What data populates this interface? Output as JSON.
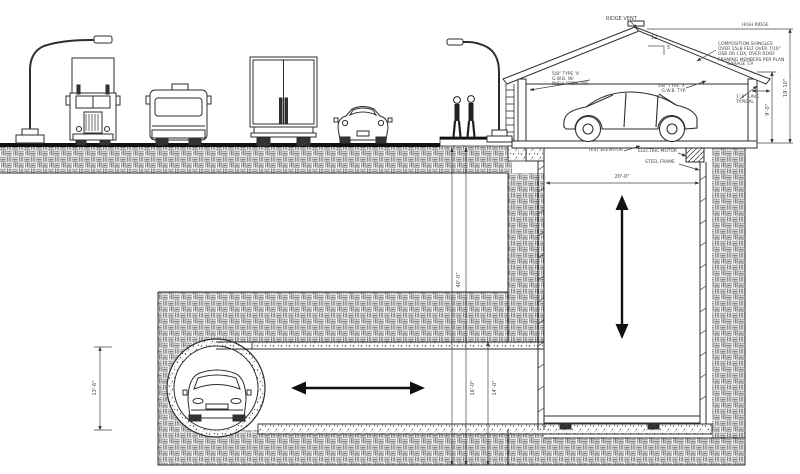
{
  "colors": {
    "line": "#2e2e2e",
    "road": "#111111",
    "background": "#ffffff",
    "hatch": "#777777"
  },
  "labels": {
    "ridge_vent": "RIDGE VENT",
    "high_ridge": "HIGH RIDGE",
    "roof_note": "COMPOSITION SHINGLES\nOVER 15LB FELT OVER 7/16\"\nOSB OR CDX, OVER ROOF\nFRAMING MEMBERS PER PLAN",
    "pitch_run": "12",
    "pitch_rise": "5",
    "garage_tp": "GARAGE T.P.",
    "gwb_note": "5/8\" TYPE 'X'\nG.W.B. TYP.",
    "eave_note": "1'-0\" EAVE\nTYPICAL",
    "insulation_note": "5/8\" TYPE 'X'\nG.W.B. W/\nINSULATION TYP.",
    "test_elevator": "TEST ELEVATOR",
    "electric_motor": "ELECTRIC MOTOR",
    "steel_frame": "STEEL FRAME"
  },
  "dimensions": {
    "ridge_height": "19'-10\"",
    "plate_height": "9'-0\"",
    "shaft_width": "20'-0\"",
    "total_depth": "40'-0\"",
    "depth_inner": "16'-0\"",
    "depth_outer": "14'-0\"",
    "tunnel_diameter": "13'-6\""
  }
}
